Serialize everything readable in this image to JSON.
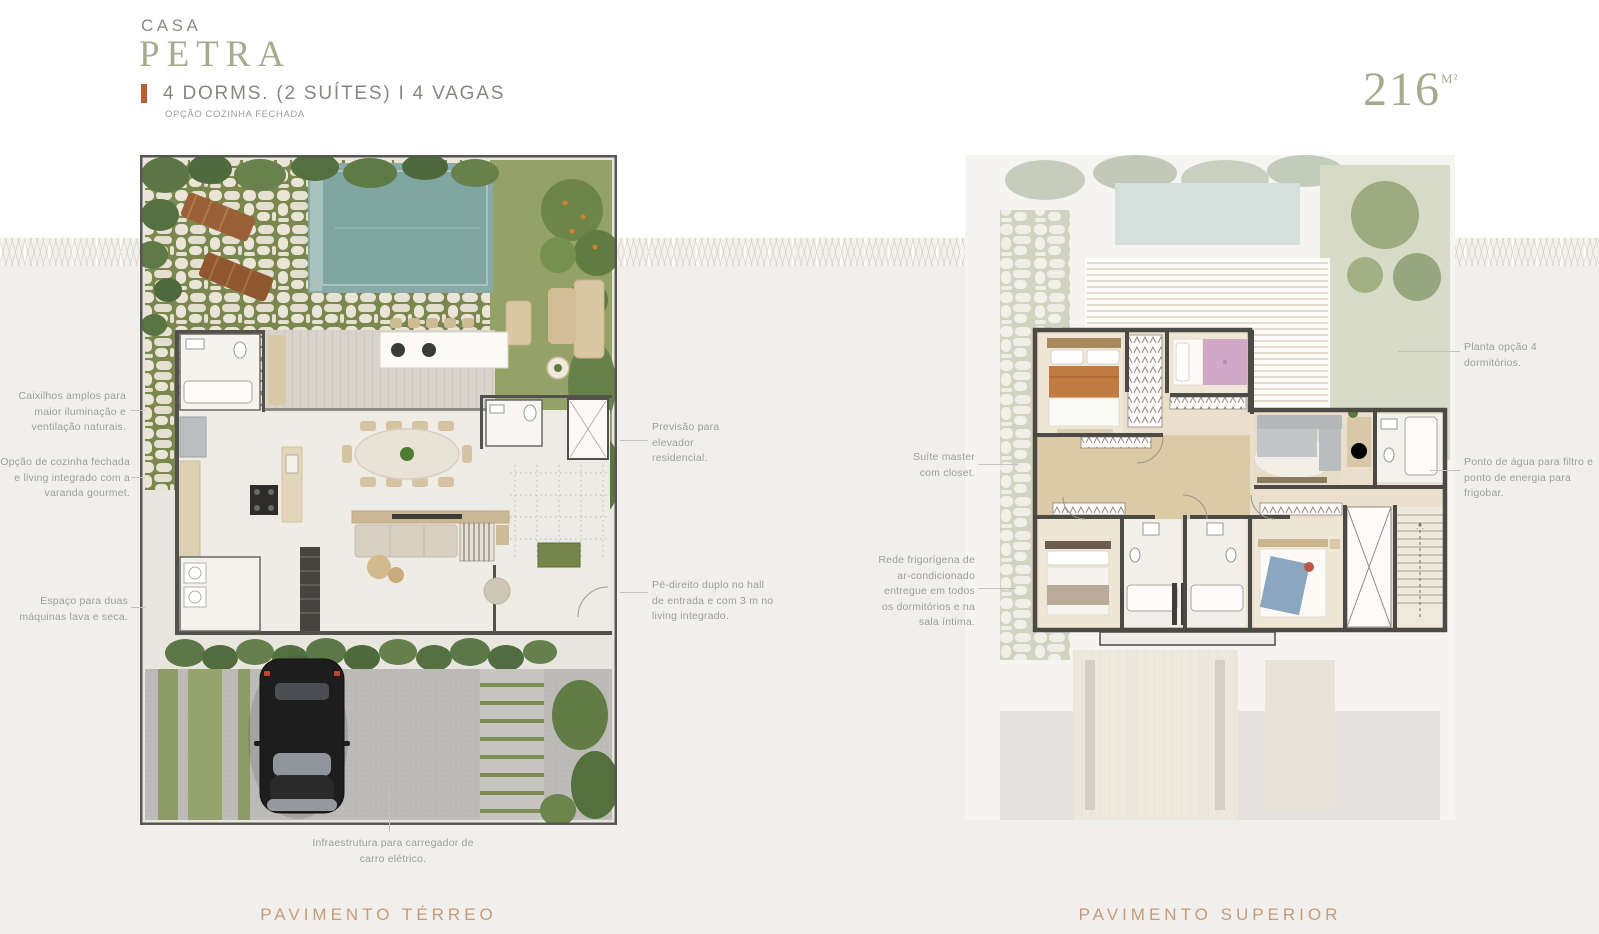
{
  "header": {
    "project_label": "CASA",
    "unit_name": "PETRA",
    "specs": "4 DORMS. (2 SUÍTES)   I   4 VAGAS",
    "option_note": "OPÇÃO COZINHA FECHADA",
    "area_value": "216",
    "area_unit": "M²"
  },
  "palette": {
    "accent_orange": "#b65f2e",
    "sage_green": "#a6ab8e",
    "caption_copper": "#c59b79",
    "annotation_gray": "#9d9d9b"
  },
  "plans": [
    {
      "id": "terreo",
      "caption": "PAVIMENTO TÉRREO"
    },
    {
      "id": "superior",
      "caption": "PAVIMENTO SUPERIOR"
    }
  ],
  "annotations": {
    "terreo_left": [
      "Caixilhos amplos para maior iluminação e ventilação naturais.",
      "Opção de cozinha fechada e living integrado com a varanda gourmet.",
      "Espaço para duas máquinas lava e seca."
    ],
    "terreo_right": [
      "Previsão para elevador residencial.",
      "Pé-direito duplo no hall de entrada e com 3 m no living integrado."
    ],
    "terreo_bottom": "Infraestrutura para carregador de carro elétrico.",
    "superior_left": [
      "Suíte master com closet.",
      "Rede frigorígena de ar-condicionado entregue em todos os dormitórios e na sala íntima."
    ],
    "superior_right": [
      "Planta opção 4 dormitórios.",
      "Ponto de água para filtro e ponto de energia para frigobar."
    ]
  }
}
